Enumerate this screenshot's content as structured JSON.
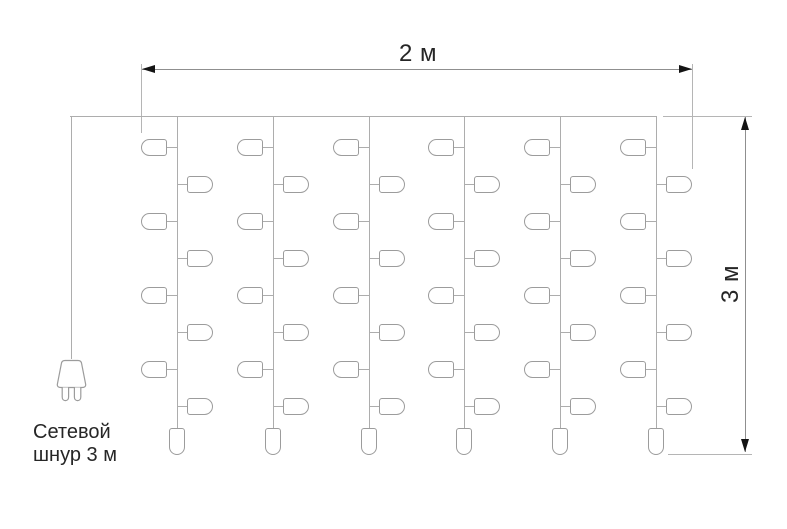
{
  "labels": {
    "width": "2 м",
    "height": "3 м",
    "cord_line1": "Сетевой",
    "cord_line2": "шнур 3 м"
  },
  "icons": {
    "plug": "power-plug-icon",
    "width_arrows": [
      "arrow-left-icon",
      "arrow-right-icon"
    ],
    "height_arrows": [
      "arrow-up-icon",
      "arrow-down-icon"
    ]
  },
  "curtain": {
    "strings_x": [
      177,
      273,
      369,
      464,
      560,
      656
    ],
    "top_y": 116,
    "string_bottom_y": 428,
    "left_bulb_rows_y": [
      147,
      221,
      295,
      369
    ],
    "right_bulb_rows_y": [
      184,
      258,
      332,
      406
    ],
    "bottom_bulb_top_y": 428,
    "counts": {
      "strings": 6,
      "side_bulbs_per_string": 8,
      "bottom_bulbs_per_string": 1,
      "total_bulbs": 54
    }
  },
  "colors": {
    "wire": "#adadad",
    "bulb_stroke": "#9c9c9c",
    "dim_line": "#8f8f8f",
    "ext_line": "#b5b5b5",
    "arrow": "#141414",
    "text": "#262626",
    "background": "#ffffff"
  }
}
